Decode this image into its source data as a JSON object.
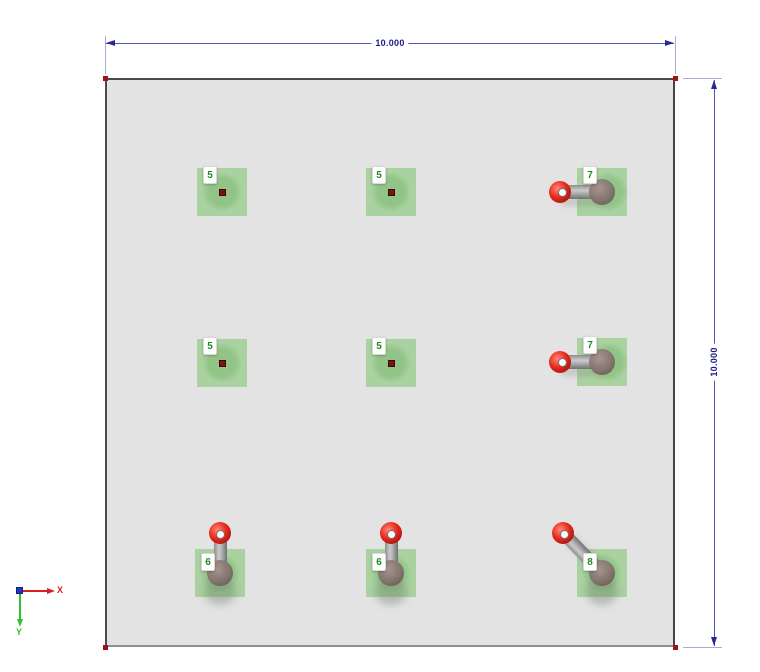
{
  "dimensions": {
    "top": {
      "value": "10.000"
    },
    "right": {
      "value": "10.000"
    }
  },
  "axes": {
    "x_label": "X",
    "y_label": "Y"
  },
  "model": {
    "plate": {
      "fill": "#e3e3e3",
      "edge": "#4a4a4a",
      "corner_node_color": "#9e1414"
    },
    "nodes": [
      {
        "label": "5",
        "x": 222,
        "y": 192,
        "type": "dot"
      },
      {
        "label": "5",
        "x": 391,
        "y": 192,
        "type": "dot"
      },
      {
        "label": "7",
        "x": 602,
        "y": 192,
        "type": "rod-left"
      },
      {
        "label": "5",
        "x": 222,
        "y": 363,
        "type": "dot"
      },
      {
        "label": "5",
        "x": 391,
        "y": 363,
        "type": "dot"
      },
      {
        "label": "7",
        "x": 602,
        "y": 362,
        "type": "rod-left"
      },
      {
        "label": "6",
        "x": 220,
        "y": 573,
        "type": "rod-up"
      },
      {
        "label": "6",
        "x": 391,
        "y": 573,
        "type": "rod-up"
      },
      {
        "label": "8",
        "x": 602,
        "y": 573,
        "type": "rod-diag"
      }
    ]
  },
  "colors": {
    "support_green": "#a9d2a0",
    "dimension_line": "#5353bd",
    "dimension_text": "#1c1c86",
    "extension_line": "#a9aecd",
    "ball_red": "#e6291c",
    "rod_gray": "#b4b4b4",
    "sphere_brown": "#82706b",
    "node_label_green": "#1e8c1e",
    "axis_x_red": "#d42020",
    "axis_y_green": "#2ec22e",
    "axis_z_blue": "#2336c6"
  }
}
